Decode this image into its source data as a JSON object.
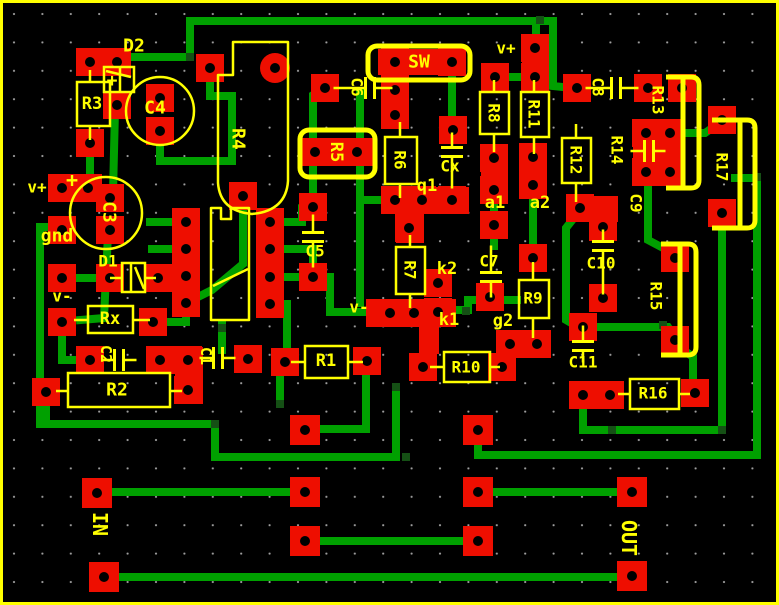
{
  "board": {
    "width": 779,
    "height": 605,
    "colors": {
      "background": "#000000",
      "border": "#ffff00",
      "pad": "#ee0e00",
      "hole": "#000000",
      "trace": "#00a000",
      "via": "#155015",
      "silkscreen": "#ffff00",
      "grid_dot": "#c8c8c8"
    },
    "grid_spacing": 28.4
  },
  "labels": [
    [
      "D2",
      134,
      46,
      0,
      18
    ],
    [
      "R3",
      92,
      104,
      0,
      17
    ],
    [
      "C4",
      155,
      108,
      0,
      18
    ],
    [
      "R4",
      238,
      139,
      90,
      18
    ],
    [
      "v+",
      506,
      48,
      0,
      16
    ],
    [
      "SW",
      419,
      62,
      0,
      18
    ],
    [
      "C6",
      357,
      87,
      90,
      16
    ],
    [
      "C8",
      598,
      87,
      90,
      16
    ],
    [
      "R13",
      658,
      100,
      90,
      16
    ],
    [
      "R8",
      494,
      113,
      90,
      16
    ],
    [
      "R11",
      534,
      114,
      90,
      16
    ],
    [
      "R14",
      617,
      150,
      90,
      16
    ],
    [
      "R12",
      576,
      160,
      90,
      16
    ],
    [
      "R17",
      722,
      167,
      90,
      16
    ],
    [
      "R5",
      336,
      152,
      90,
      17
    ],
    [
      "R6",
      400,
      160,
      90,
      16
    ],
    [
      "Cx",
      450,
      166,
      0,
      16
    ],
    [
      "q1",
      427,
      186,
      0,
      17
    ],
    [
      "v+",
      37,
      187,
      0,
      16
    ],
    [
      "+",
      72,
      180,
      0,
      20
    ],
    [
      "+",
      112,
      81,
      0,
      18
    ],
    [
      "a1",
      495,
      203,
      0,
      17
    ],
    [
      "a2",
      540,
      203,
      0,
      17
    ],
    [
      "C3",
      109,
      212,
      90,
      18
    ],
    [
      "C9",
      636,
      203,
      90,
      16
    ],
    [
      "gnd",
      57,
      236,
      0,
      18
    ],
    [
      "C5",
      315,
      251,
      0,
      16
    ],
    [
      "D1",
      108,
      261,
      0,
      16
    ],
    [
      "C10",
      601,
      263,
      0,
      16
    ],
    [
      "R7",
      410,
      270,
      90,
      16
    ],
    [
      "k2",
      447,
      269,
      0,
      17
    ],
    [
      "C7",
      489,
      261,
      0,
      16
    ],
    [
      "v-",
      62,
      296,
      0,
      16
    ],
    [
      "Rx",
      110,
      319,
      0,
      17
    ],
    [
      "R9",
      533,
      298,
      0,
      16
    ],
    [
      "R15",
      656,
      296,
      90,
      16
    ],
    [
      "v-",
      359,
      307,
      0,
      16
    ],
    [
      "k1",
      449,
      320,
      0,
      17
    ],
    [
      "g2",
      503,
      321,
      0,
      17
    ],
    [
      "C2",
      106,
      354,
      90,
      15
    ],
    [
      "C1",
      206,
      356,
      90,
      15
    ],
    [
      "R1",
      326,
      361,
      0,
      17
    ],
    [
      "C11",
      583,
      362,
      0,
      16
    ],
    [
      "R10",
      466,
      367,
      0,
      16
    ],
    [
      "R2",
      117,
      390,
      0,
      18
    ],
    [
      "R16",
      653,
      393,
      0,
      16
    ],
    [
      "IN",
      100,
      524,
      90,
      20
    ],
    [
      "OUT",
      629,
      538,
      90,
      20
    ]
  ],
  "pads": [
    [
      90,
      62
    ],
    [
      117,
      62
    ],
    [
      117,
      105
    ],
    [
      90,
      143
    ],
    [
      160,
      98
    ],
    [
      160,
      131
    ],
    [
      210,
      68
    ],
    [
      62,
      188
    ],
    [
      88,
      188
    ],
    [
      110,
      198
    ],
    [
      110,
      230
    ],
    [
      62,
      230
    ],
    [
      62,
      278
    ],
    [
      110,
      278
    ],
    [
      158,
      278
    ],
    [
      62,
      322
    ],
    [
      153,
      322
    ],
    [
      46,
      392
    ],
    [
      90,
      360
    ],
    [
      160,
      360
    ],
    [
      188,
      360
    ],
    [
      188,
      390
    ],
    [
      248,
      359
    ],
    [
      285,
      362
    ],
    [
      367,
      361
    ],
    [
      243,
      196
    ],
    [
      186,
      222
    ],
    [
      186,
      249
    ],
    [
      186,
      276
    ],
    [
      186,
      303
    ],
    [
      270,
      222
    ],
    [
      270,
      249
    ],
    [
      270,
      277
    ],
    [
      270,
      304
    ],
    [
      313,
      207
    ],
    [
      313,
      277
    ],
    [
      325,
      88
    ],
    [
      395,
      62
    ],
    [
      452,
      62
    ],
    [
      315,
      152
    ],
    [
      357,
      152
    ],
    [
      395,
      90
    ],
    [
      395,
      115
    ],
    [
      453,
      130
    ],
    [
      395,
      200
    ],
    [
      422,
      200
    ],
    [
      452,
      200
    ],
    [
      409,
      228
    ],
    [
      535,
      48
    ],
    [
      535,
      77
    ],
    [
      495,
      77
    ],
    [
      494,
      158
    ],
    [
      494,
      190
    ],
    [
      533,
      157
    ],
    [
      533,
      185
    ],
    [
      494,
      225
    ],
    [
      490,
      297
    ],
    [
      533,
      258
    ],
    [
      510,
      344
    ],
    [
      537,
      344
    ],
    [
      438,
      283
    ],
    [
      390,
      313
    ],
    [
      414,
      313
    ],
    [
      438,
      312
    ],
    [
      423,
      367
    ],
    [
      502,
      367
    ],
    [
      577,
      88
    ],
    [
      648,
      88
    ],
    [
      682,
      88
    ],
    [
      646,
      133
    ],
    [
      670,
      133
    ],
    [
      646,
      172
    ],
    [
      670,
      172
    ],
    [
      580,
      208
    ],
    [
      603,
      227
    ],
    [
      603,
      298
    ],
    [
      675,
      258
    ],
    [
      675,
      340
    ],
    [
      722,
      120
    ],
    [
      722,
      213
    ],
    [
      583,
      327
    ],
    [
      583,
      395
    ],
    [
      610,
      395
    ],
    [
      695,
      393
    ],
    [
      97,
      493,
      30
    ],
    [
      104,
      577,
      30
    ],
    [
      305,
      430,
      30
    ],
    [
      478,
      430,
      30
    ],
    [
      305,
      492,
      30
    ],
    [
      478,
      492,
      30
    ],
    [
      305,
      541,
      30
    ],
    [
      478,
      541,
      30
    ],
    [
      632,
      492,
      30
    ],
    [
      632,
      576,
      30
    ]
  ],
  "round_pads": [
    [
      275,
      68,
      15
    ]
  ],
  "blocks": [
    [
      381,
      187,
      88,
      27
    ],
    [
      396,
      213,
      28,
      30
    ],
    [
      366,
      299,
      90,
      28
    ],
    [
      419,
      326,
      20,
      28
    ],
    [
      378,
      49,
      85,
      26
    ],
    [
      303,
      138,
      70,
      28
    ],
    [
      147,
      347,
      56,
      27
    ],
    [
      175,
      347,
      28,
      57
    ],
    [
      481,
      147,
      27,
      57
    ],
    [
      520,
      146,
      27,
      53
    ],
    [
      522,
      36,
      27,
      55
    ],
    [
      633,
      120,
      50,
      66
    ],
    [
      382,
      78,
      27,
      50
    ],
    [
      566,
      196,
      52,
      26
    ]
  ],
  "traces": [
    [
      [
        120,
        57
      ],
      [
        190,
        57
      ],
      [
        190,
        21
      ],
      [
        553,
        21
      ],
      [
        553,
        86
      ],
      [
        572,
        88
      ]
    ],
    [
      [
        536,
        21
      ],
      [
        536,
        46
      ]
    ],
    [
      [
        160,
        135
      ],
      [
        160,
        161
      ],
      [
        232,
        161
      ],
      [
        232,
        96
      ],
      [
        210,
        96
      ],
      [
        210,
        71
      ]
    ],
    [
      [
        115,
        110
      ],
      [
        113,
        193
      ]
    ],
    [
      [
        90,
        148
      ],
      [
        90,
        185
      ]
    ],
    [
      [
        62,
        227
      ],
      [
        40,
        227
      ],
      [
        40,
        424
      ],
      [
        215,
        424
      ],
      [
        215,
        457
      ],
      [
        396,
        457
      ],
      [
        396,
        387
      ]
    ],
    [
      [
        46,
        397
      ],
      [
        46,
        424
      ]
    ],
    [
      [
        88,
        190
      ],
      [
        108,
        197
      ]
    ],
    [
      [
        108,
        234
      ],
      [
        104,
        318
      ],
      [
        80,
        320
      ]
    ],
    [
      [
        62,
        278
      ],
      [
        110,
        278
      ]
    ],
    [
      [
        158,
        278
      ],
      [
        186,
        277
      ]
    ],
    [
      [
        153,
        322
      ],
      [
        186,
        322
      ],
      [
        186,
        306
      ]
    ],
    [
      [
        62,
        334
      ],
      [
        62,
        360
      ],
      [
        78,
        360
      ]
    ],
    [
      [
        150,
        222
      ],
      [
        186,
        222
      ]
    ],
    [
      [
        152,
        249
      ],
      [
        186,
        249
      ]
    ],
    [
      [
        152,
        276
      ],
      [
        186,
        276
      ]
    ],
    [
      [
        243,
        200
      ],
      [
        243,
        264
      ],
      [
        212,
        290
      ],
      [
        190,
        301
      ]
    ],
    [
      [
        270,
        222
      ],
      [
        302,
        222
      ],
      [
        302,
        208
      ],
      [
        313,
        207
      ]
    ],
    [
      [
        270,
        249
      ],
      [
        313,
        249
      ],
      [
        313,
        266
      ]
    ],
    [
      [
        270,
        277
      ],
      [
        330,
        277
      ],
      [
        330,
        312
      ],
      [
        372,
        312
      ]
    ],
    [
      [
        270,
        304
      ],
      [
        287,
        304
      ],
      [
        287,
        356
      ]
    ],
    [
      [
        313,
        200
      ],
      [
        313,
        95
      ],
      [
        322,
        89
      ]
    ],
    [
      [
        360,
        92
      ],
      [
        360,
        303
      ]
    ],
    [
      [
        360,
        200
      ],
      [
        384,
        200
      ]
    ],
    [
      [
        395,
        70
      ],
      [
        395,
        93
      ]
    ],
    [
      [
        452,
        68
      ],
      [
        452,
        126
      ]
    ],
    [
      [
        495,
        77
      ],
      [
        533,
        77
      ]
    ],
    [
      [
        533,
        190
      ],
      [
        533,
        260
      ]
    ],
    [
      [
        494,
        196
      ],
      [
        494,
        246
      ]
    ],
    [
      [
        452,
        310
      ],
      [
        468,
        310
      ],
      [
        468,
        300
      ],
      [
        517,
        300
      ]
    ],
    [
      [
        503,
        350
      ],
      [
        503,
        364
      ]
    ],
    [
      [
        306,
        429
      ],
      [
        366,
        429
      ],
      [
        366,
        363
      ]
    ],
    [
      [
        478,
        437
      ],
      [
        478,
        455
      ],
      [
        757,
        455
      ],
      [
        757,
        178
      ],
      [
        735,
        178
      ]
    ],
    [
      [
        97,
        492
      ],
      [
        305,
        492
      ]
    ],
    [
      [
        478,
        492
      ],
      [
        632,
        492
      ]
    ],
    [
      [
        104,
        577
      ],
      [
        632,
        577
      ]
    ],
    [
      [
        306,
        541
      ],
      [
        478,
        541
      ]
    ],
    [
      [
        583,
        400
      ],
      [
        583,
        430
      ],
      [
        722,
        430
      ],
      [
        722,
        228
      ]
    ],
    [
      [
        648,
        177
      ],
      [
        648,
        240
      ],
      [
        665,
        249
      ]
    ],
    [
      [
        590,
        327
      ],
      [
        668,
        327
      ],
      [
        674,
        336
      ]
    ],
    [
      [
        577,
        214
      ],
      [
        566,
        228
      ],
      [
        566,
        320
      ],
      [
        578,
        327
      ]
    ],
    [
      [
        672,
        133
      ],
      [
        705,
        133
      ],
      [
        718,
        124
      ]
    ],
    [
      [
        677,
        345
      ],
      [
        693,
        357
      ],
      [
        693,
        382
      ]
    ],
    [
      [
        280,
        376
      ],
      [
        280,
        403
      ]
    ],
    [
      [
        222,
        325
      ],
      [
        222,
        350
      ]
    ]
  ],
  "vias": [
    [
      190,
      57
    ],
    [
      540,
      20
    ],
    [
      215,
      424
    ],
    [
      406,
      457
    ],
    [
      396,
      387
    ],
    [
      466,
      311
    ],
    [
      612,
      430
    ],
    [
      722,
      430
    ],
    [
      757,
      177
    ],
    [
      648,
      179
    ],
    [
      588,
      325
    ],
    [
      663,
      325
    ],
    [
      222,
      328
    ],
    [
      280,
      404
    ],
    [
      537,
      46
    ]
  ],
  "silk": {
    "rects": [
      [
        77,
        82,
        33,
        44,
        2.5,
        0
      ],
      [
        88,
        306,
        45,
        27,
        2.5,
        0
      ],
      [
        68,
        373,
        102,
        34,
        2.5,
        0
      ],
      [
        305,
        346,
        43,
        32,
        2.5,
        0
      ],
      [
        385,
        137,
        32,
        47,
        2.5,
        0
      ],
      [
        396,
        247,
        29,
        47,
        2.5,
        0
      ],
      [
        480,
        92,
        29,
        42,
        2.5,
        0
      ],
      [
        521,
        92,
        28,
        45,
        2.5,
        0
      ],
      [
        562,
        138,
        29,
        45,
        2.5,
        0
      ],
      [
        519,
        280,
        30,
        38,
        2.5,
        0
      ],
      [
        444,
        352,
        46,
        30,
        2.5,
        0
      ],
      [
        630,
        379,
        49,
        30,
        2.5,
        0
      ],
      [
        368,
        46,
        102,
        34,
        5,
        9
      ],
      [
        300,
        130,
        75,
        47,
        5,
        9
      ],
      [
        104,
        67,
        30,
        25,
        2.5,
        0
      ],
      [
        122,
        263,
        23,
        29,
        2.5,
        0
      ]
    ],
    "circles": [
      [
        106,
        213,
        36
      ],
      [
        160,
        111,
        34
      ]
    ],
    "paths": [
      [
        "M233,42 L233,75 L218,75 L218,183 Q220,211 252,214 Q286,211 288,181 L288,42 Z",
        2.5
      ],
      [
        "M211,208 L221,208 L221,219 L231,219 L231,208 L249,208 L249,320 L211,320 Z",
        2.5
      ],
      [
        "M213,286 L248,269",
        2.5
      ],
      [
        "M666,77 L691,77 Q699,77 699,85 L699,180 Q699,188 691,188 L666,188",
        5
      ],
      [
        "M683,79 L683,186",
        5
      ],
      [
        "M661,244 L688,244 Q696,244 696,252 L696,347 Q696,355 688,355 L661,355",
        5
      ],
      [
        "M680,246 L680,353",
        5
      ],
      [
        "M712,120 L747,120 Q755,120 755,128 L755,220 Q755,228 747,228 L712,228",
        5
      ],
      [
        "M740,122 L740,226",
        5
      ],
      [
        "M120,67 L120,92",
        2.5
      ],
      [
        "M106,71 L131,77",
        2.5
      ],
      [
        "M131,263 L131,292",
        2.5
      ],
      [
        "M135,267 L144,289",
        2.5
      ]
    ],
    "caps": [
      [
        370,
        88,
        0,
        32,
        18
      ],
      [
        616,
        88,
        0,
        26,
        18
      ],
      [
        649,
        151,
        0,
        14,
        12
      ],
      [
        119,
        360,
        0,
        13,
        13
      ],
      [
        218,
        358,
        0,
        14,
        13
      ],
      [
        452,
        152,
        90,
        15,
        32
      ],
      [
        313,
        237,
        90,
        18,
        26
      ],
      [
        491,
        277,
        90,
        27,
        16
      ],
      [
        603,
        246,
        90,
        12,
        44
      ],
      [
        583,
        346,
        90,
        16,
        12
      ]
    ],
    "leads": [
      [
        90,
        70,
        90,
        82
      ],
      [
        90,
        126,
        90,
        140
      ],
      [
        74,
        320,
        88,
        320
      ],
      [
        133,
        320,
        150,
        320
      ],
      [
        56,
        391,
        68,
        391
      ],
      [
        170,
        391,
        182,
        391
      ],
      [
        291,
        362,
        305,
        362
      ],
      [
        348,
        362,
        363,
        362
      ],
      [
        400,
        122,
        400,
        137
      ],
      [
        400,
        184,
        400,
        198
      ],
      [
        410,
        235,
        410,
        247
      ],
      [
        410,
        294,
        410,
        308
      ],
      [
        494,
        80,
        494,
        92
      ],
      [
        494,
        134,
        494,
        152
      ],
      [
        534,
        80,
        534,
        92
      ],
      [
        534,
        137,
        534,
        154
      ],
      [
        576,
        124,
        576,
        138
      ],
      [
        576,
        183,
        576,
        202
      ],
      [
        533,
        262,
        533,
        280
      ],
      [
        533,
        318,
        533,
        338
      ],
      [
        430,
        367,
        444,
        367
      ],
      [
        490,
        367,
        500,
        367
      ],
      [
        618,
        394,
        630,
        394
      ],
      [
        679,
        394,
        690,
        394
      ],
      [
        110,
        278,
        122,
        278
      ],
      [
        145,
        278,
        156,
        278
      ]
    ]
  }
}
